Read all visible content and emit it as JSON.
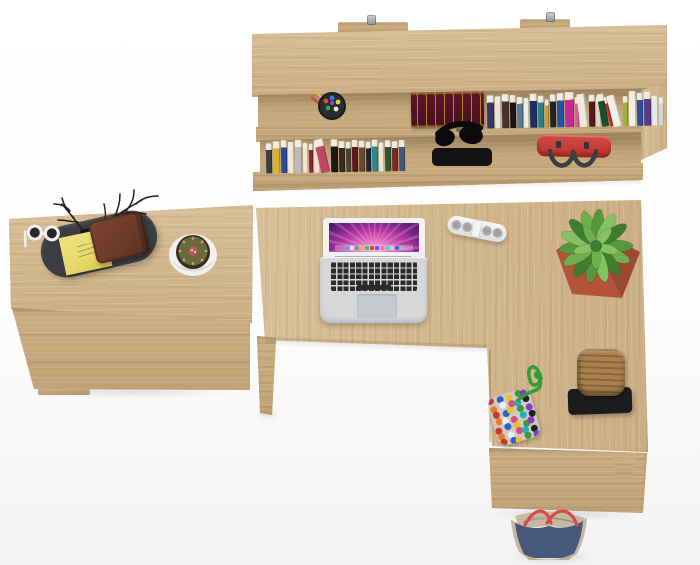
{
  "meta": {
    "description": "Top-down studio render of a light-oak home office: wall shelf with books and red handbag, L-shaped desk with MacBook, power strip, potted plants, side cabinet with valet tray, wicker basket and bags",
    "image_type": "furniture product render"
  },
  "palette": {
    "wood-top": "#d8bf97",
    "wood-top2": "#ccae83",
    "wood-front": "#cbae81",
    "wood-front2": "#c0a274",
    "wood-recess": "#c6a87b",
    "page-top": "#f1ecdd",
    "tray": "#3a3d41",
    "sticky": "#e7d96b",
    "wallet": "#6f3b29",
    "pot": "#b2543a",
    "soil": "#3c2b1f",
    "plant1": "#3f7d2f",
    "plant2": "#58973d",
    "plant3": "#6fae4e",
    "plant4": "#86c162",
    "cactus": "#5c7038",
    "spine": "#a05048",
    "white-pot": "#f1f1ef",
    "silver": "#d5d7d9",
    "bezel": "#f1f2f3",
    "key": "#2a2b2d",
    "track": "#c7cacd",
    "strip": "#efefef",
    "grille": "#b9bcbe",
    "basket": "#ab8150",
    "basket-dark": "#8a663a",
    "stand": "#1b1c1e",
    "redbag": "#c0332e",
    "handle": "#3d3d44",
    "maroon": "#541524",
    "gold": "#c9a22c",
    "cup": "#27292c",
    "cord": "#2f9e33",
    "pouch": "#cfc9c2",
    "bagblue": "#47597a",
    "bagbeige": "#c6b8a2",
    "bagred": "#d64a4a"
  },
  "shelf": {
    "upper_books": [
      {
        "c": "#2e3a6e",
        "w": 7,
        "h": 33
      },
      {
        "c": "#e8e3d4",
        "w": 6,
        "h": 32
      },
      {
        "c": "#4a3226",
        "w": 7,
        "h": 34
      },
      {
        "c": "#17171a",
        "w": 6,
        "h": 33
      },
      {
        "c": "#5d7b94",
        "w": 6,
        "h": 31
      },
      {
        "c": "#f0ece0",
        "w": 5,
        "h": 30
      },
      {
        "c": "#1d2f5e",
        "w": 7,
        "h": 34
      },
      {
        "c": "#2a7f86",
        "w": 6,
        "h": 32
      },
      {
        "c": "#c9a12e",
        "w": 4,
        "h": 28
      },
      {
        "c": "#23242a",
        "w": 6,
        "h": 33
      },
      {
        "c": "#2255a8",
        "w": 7,
        "h": 34
      },
      {
        "c": "#c42a96",
        "w": 9,
        "h": 35
      },
      {
        "c": "#e05a9a",
        "w": 4,
        "h": 30
      },
      {
        "c": "#efe9dc",
        "w": 8,
        "h": 33,
        "r": 6
      },
      {
        "c": "#5a1622",
        "w": 6,
        "h": 32
      },
      {
        "c": "#ded6c2",
        "w": 5,
        "h": 30
      },
      {
        "c": "#1d4d2a",
        "w": 7,
        "h": 33,
        "r": 9
      },
      {
        "c": "#c03030",
        "w": 3,
        "h": 30,
        "r": 12
      },
      {
        "c": "#eef0ea",
        "w": 8,
        "h": 32,
        "r": 14
      },
      {
        "c": "#9ab23a",
        "w": 5,
        "h": 30
      },
      {
        "c": "#f2efe6",
        "w": 7,
        "h": 35
      },
      {
        "c": "#2a4fa0",
        "w": 6,
        "h": 33
      },
      {
        "c": "#5a3a8c",
        "w": 7,
        "h": 34
      },
      {
        "c": "#e6e9ee",
        "w": 6,
        "h": 30
      },
      {
        "c": "#cfd6de",
        "w": 5,
        "h": 28
      }
    ],
    "lower_books": [
      {
        "c": "#3a3f44",
        "w": 6,
        "h": 30
      },
      {
        "c": "#d8b52a",
        "w": 7,
        "h": 32
      },
      {
        "c": "#2a4a9a",
        "w": 6,
        "h": 33
      },
      {
        "c": "#ece8da",
        "w": 6,
        "h": 31
      },
      {
        "c": "#b9bcc0",
        "w": 7,
        "h": 33
      },
      {
        "c": "#efe6d4",
        "w": 5,
        "h": 30
      },
      {
        "c": "#8a2430",
        "w": 4,
        "h": 29
      },
      {
        "c": "#e8e2d2",
        "w": 6,
        "h": 31
      },
      {
        "c": "#c04860",
        "w": 9,
        "h": 34,
        "r": 12
      },
      {
        "c": "#17181c",
        "w": 7,
        "h": 33
      },
      {
        "c": "#3c2a1e",
        "w": 6,
        "h": 31
      },
      {
        "c": "#4a4432",
        "w": 5,
        "h": 30
      },
      {
        "c": "#5c1a20",
        "w": 6,
        "h": 32
      },
      {
        "c": "#6b4a2a",
        "w": 6,
        "h": 31
      },
      {
        "c": "#23252a",
        "w": 5,
        "h": 30
      },
      {
        "c": "#2a8a8a",
        "w": 6,
        "h": 32
      },
      {
        "c": "#e9e5d8",
        "w": 5,
        "h": 29
      },
      {
        "c": "#2a5a34",
        "w": 6,
        "h": 31
      },
      {
        "c": "#7a2a22",
        "w": 6,
        "h": 30
      },
      {
        "c": "#44597a",
        "w": 6,
        "h": 31
      }
    ]
  },
  "pompom": {
    "colors": [
      "#cc3333",
      "#2a62c8",
      "#e8c32a",
      "#3a9a3a",
      "#8a3ac0",
      "#e87a2a",
      "#efefef",
      "#d84a8a",
      "#20b2b2",
      "#222222"
    ]
  },
  "laptop": {
    "dock_colors": [
      "#5aa2e8",
      "#e8e8e8",
      "#8a8f96",
      "#e8b64a",
      "#4ac25a",
      "#d84a4a",
      "#7a4ae0",
      "#e87ab0",
      "#4ad2e8",
      "#c9cdd2",
      "#3a6ae0",
      "#aab2ba"
    ]
  },
  "objects": [
    "wall-shelf",
    "mount-brackets",
    "pen-cup",
    "antique-maroon-book",
    "book-rows",
    "headphones",
    "red-handbag",
    "left-cabinet",
    "valet-tray",
    "branch-decor",
    "sunglasses",
    "sticky-notes",
    "leather-wallet",
    "cactus-pot",
    "macbook-laptop",
    "power-strip",
    "potted-succulent",
    "l-shaped-desk",
    "pompom-pouch",
    "green-cord",
    "wicker-basket",
    "black-stand",
    "floor-tote-bag"
  ]
}
